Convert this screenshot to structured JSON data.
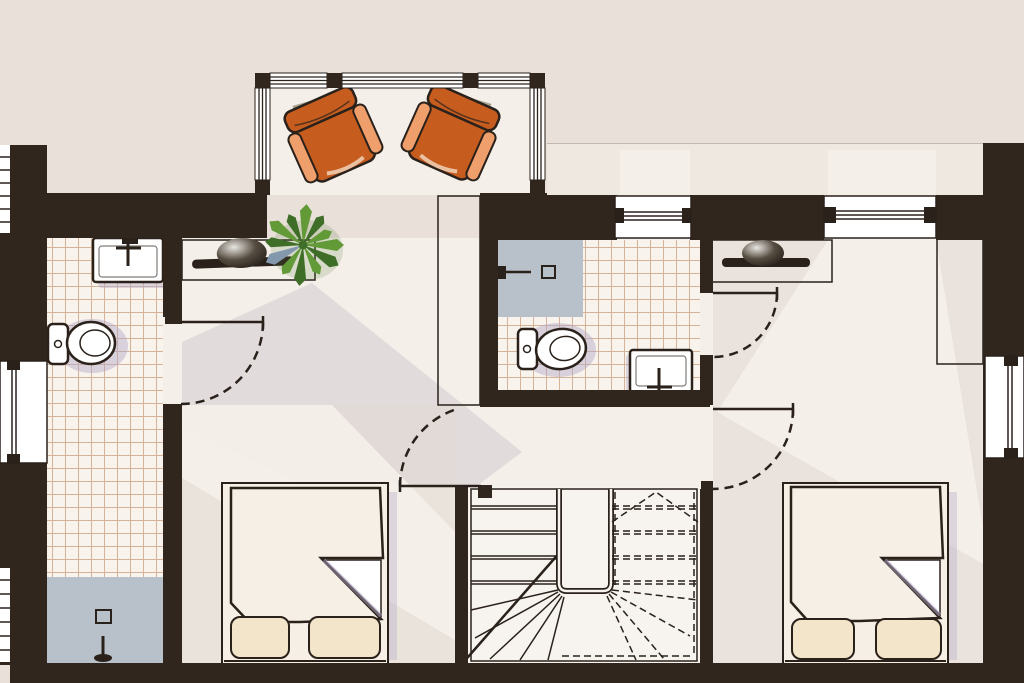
{
  "image_type": "architectural floor plan (upper storey), hand-rendered style, no text labels visible",
  "palette": {
    "background": "#e8e0d9",
    "floor": "#f4efe9",
    "terrace": "#efe8e1",
    "wall": "#31261e",
    "line": "#2a211b",
    "tile": "#f8f3ec",
    "tile-line": "#c89d7c",
    "shower": "#b8c1ca",
    "wood-dark": "#6f3d1f",
    "wood-mid": "#9a5830",
    "wood-light": "#b97c4c",
    "duvet": "#bf7113",
    "duvet-line": "#f2b255",
    "pillow": "#f3e5c9",
    "bed-frame": "#f6efe5",
    "chair": "#c65d1f",
    "chair-light": "#ef9f6b",
    "plant": "#619a36",
    "plant-dark": "#3e6e28",
    "plant-blue": "#8398ad",
    "shadow": "#cfc8cf",
    "room-shade": "#e0d8d2",
    "fixture-shadow": "#b1a6c6",
    "white": "#ffffff",
    "chair-shadow": "#a8a291"
  },
  "rooms": [
    {
      "name": "balcony-lounge",
      "furniture": [
        "armchair",
        "armchair"
      ]
    },
    {
      "name": "bathroom-left",
      "furniture": [
        "washbasin",
        "toilet",
        "shower-tray"
      ]
    },
    {
      "name": "hallway-landing",
      "furniture": [
        "sideboard-with-tv",
        "potted-plant",
        "wardrobe"
      ]
    },
    {
      "name": "ensuite-bathroom",
      "furniture": [
        "shower-tray",
        "toilet",
        "washbasin"
      ]
    },
    {
      "name": "bedroom-left",
      "furniture": [
        "double-bed-with-plaid-duvet"
      ]
    },
    {
      "name": "bedroom-right",
      "furniture": [
        "sideboard-with-tv",
        "wardrobe",
        "double-bed-with-plaid-duvet"
      ]
    },
    {
      "name": "staircase",
      "furniture": [
        "u-shaped-winder-stair"
      ]
    }
  ],
  "openings": {
    "door_count": 4,
    "doors": [
      "bathroom-left-door",
      "ensuite-door",
      "bedroom-left-door",
      "bedroom-right-door"
    ],
    "windows": [
      "balcony-glazing-band",
      "ensuite-window-north",
      "bedroom-right-window-north",
      "bedroom-right-window-east",
      "bathroom-left-window-west",
      "louvre-strip-top-left",
      "louvre-strip-bottom-left"
    ]
  },
  "visible_text": []
}
